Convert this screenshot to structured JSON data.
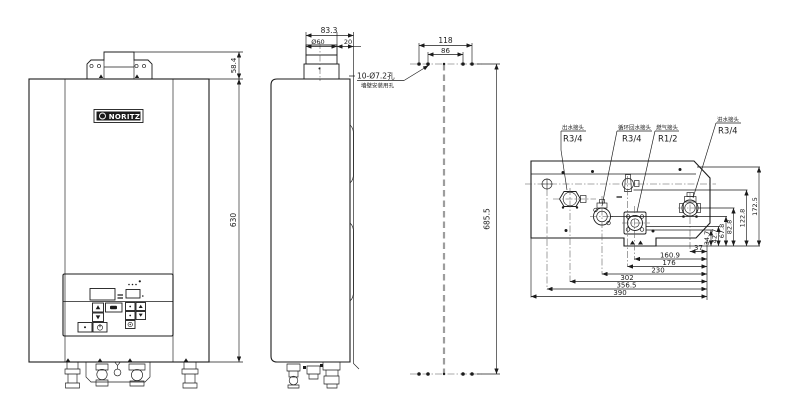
{
  "front": {
    "brand": "NORITZ",
    "dim_bracket": "58.4",
    "dim_height": "630"
  },
  "side": {
    "dim_total": "83.3",
    "dim_flue": "Ø60",
    "dim_offset": "20"
  },
  "mount": {
    "note": "10-Ø7.2孔",
    "note_sub": "墙壁安装用孔",
    "dim_w_outer": "118",
    "dim_w_inner": "86",
    "dim_h": "685.5"
  },
  "bottom": {
    "labels": [
      {
        "cn": "出水接头",
        "size": "R3/4"
      },
      {
        "cn": "循环回水接头",
        "size": "R3/4"
      },
      {
        "cn": "燃气接头",
        "size": "R1/2"
      },
      {
        "cn": "进水接头",
        "size": "R3/4"
      }
    ],
    "hdims": [
      "37",
      "160.9",
      "176",
      "230",
      "302",
      "356.5",
      "390"
    ],
    "vdims": [
      "34.7",
      "42.7",
      "67.8",
      "82.8",
      "122.8",
      "172.5"
    ]
  }
}
